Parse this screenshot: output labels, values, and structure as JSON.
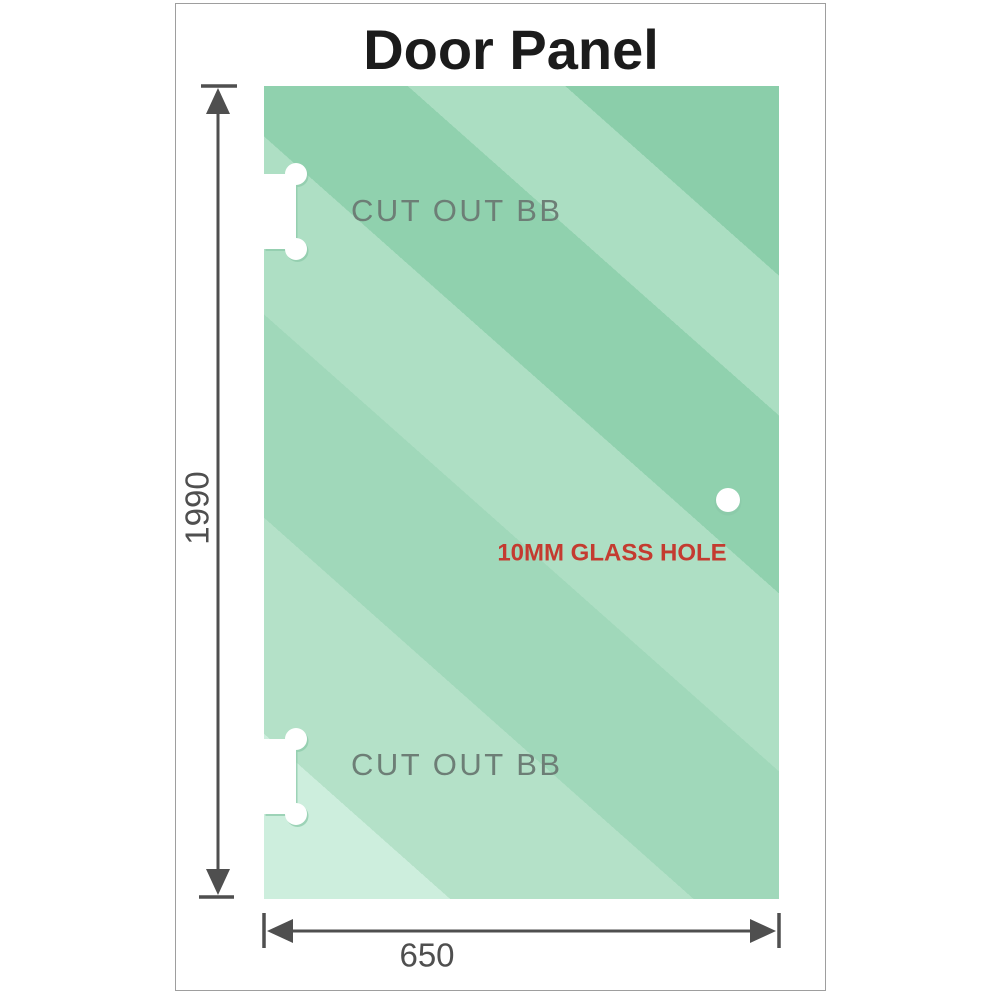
{
  "title": "Door Panel",
  "panel": {
    "cutout_top": {
      "label": "CUT OUT BB"
    },
    "cutout_bottom": {
      "label": "CUT OUT BB"
    },
    "hole": {
      "label": "10MM GLASS HOLE"
    }
  },
  "dimensions": {
    "height_value": "1990",
    "width_value": "650"
  },
  "colors": {
    "title": "#1b1b1b",
    "dimension": "#4f4f4f",
    "cutout_label": "#6d7e76",
    "hole_label": "#c43b30",
    "frame_border": "#9e9e9e",
    "cutout_fill": "#ffffff",
    "hole_fill": "#ffffff",
    "cutout_outline": "#8ccaa9",
    "glass_bands": [
      "#cdeedd",
      "#b4e1c8",
      "#a0d8ba",
      "#aedfc4",
      "#90d1ae",
      "#abdec2",
      "#8bceaa"
    ]
  }
}
